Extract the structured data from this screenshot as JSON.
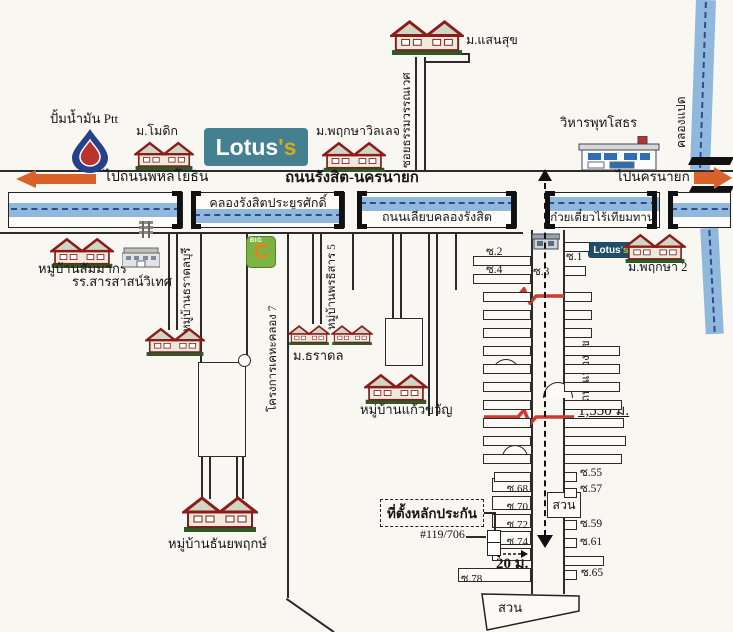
{
  "logos": {
    "lotus": {
      "name": "Lotus",
      "s": "'s"
    },
    "bigc": {
      "big": "BIG",
      "c": "C"
    }
  },
  "labels": {
    "ptt": "ปั้มน้ำมัน Ptt",
    "modik": "ม.โมดิก",
    "pruksa_village": "ม.พฤกษาวิลเลจ",
    "saensuk": "ม.แสนสุข",
    "soi_wannawet": "ซอยธรรมวรรณเวศ",
    "wihan": "วิหารพุทโสธร",
    "khlong8": "คลองแปด",
    "to_phahonyothin": "ไปถนนพหลโยธิน",
    "rangsit_nakhonnayok_road": "ถนนรังสิต-นครนายก",
    "to_nakhonnayok": "ไปนครนายก",
    "khlong_rangsit": "คลองรังสิตประยูรศักดิ์",
    "liap_khlong_road": "ถนนเลียบคลองรังสิต",
    "noodle_shop": "ก๋วยเตี๋ยวไร้เทียมทาน",
    "sammakorn": "หมู่บ้านสัมมากร",
    "sarasas_school": "รร.สารสาสน์วิเทศ",
    "taradonburi": "หมู่บ้านธราดลบุรี",
    "keha_khlong7": "โครงการเคหะคลอง 7",
    "phonthisan": "หมู่บ้านพรธิสาร 5",
    "taradon": "ม.ธราดล",
    "kaewkhwan": "หมู่บ้านแก้วขวัญ",
    "thanyapruek": "หมู่บ้านธันยพฤกษ์",
    "pruksa2": "ม.พฤกษา 2",
    "mueangsuk_road": "ถนนเมืองสุข 1",
    "distance": "1,550 ม.",
    "width_20m": "20 ม.",
    "collateral": "ที่ตั้งหลักประกัน",
    "house_no": "#119/706",
    "park": "สวน",
    "sois": {
      "s1": "ซ.1",
      "s2": "ซ.2",
      "s3": "ซ.3",
      "s4": "ซ.4",
      "s55": "ซ.55",
      "s57": "ซ.57",
      "s59": "ซ.59",
      "s61": "ซ.61",
      "s65": "ซ.65",
      "s68": "ซ.68",
      "s70": "ซ.70",
      "s72": "ซ.72",
      "s74": "ซ.74",
      "s78": "ซ.78"
    }
  },
  "colors": {
    "canal": "#8fb8dc",
    "canal_line": "#2f4d8a",
    "road": "#2b2b2b",
    "orange": "#d9622b",
    "lotus_teal": "#44808f",
    "lotus_navy": "#1f4e6b",
    "lotus_gold": "#d9a91c",
    "lotus_lime": "#a4c93f",
    "bigc_green": "#7cb342",
    "bigc_orange": "#f47a20",
    "accent_red": "#cc3b2f",
    "paper": "#f8f7f2"
  }
}
